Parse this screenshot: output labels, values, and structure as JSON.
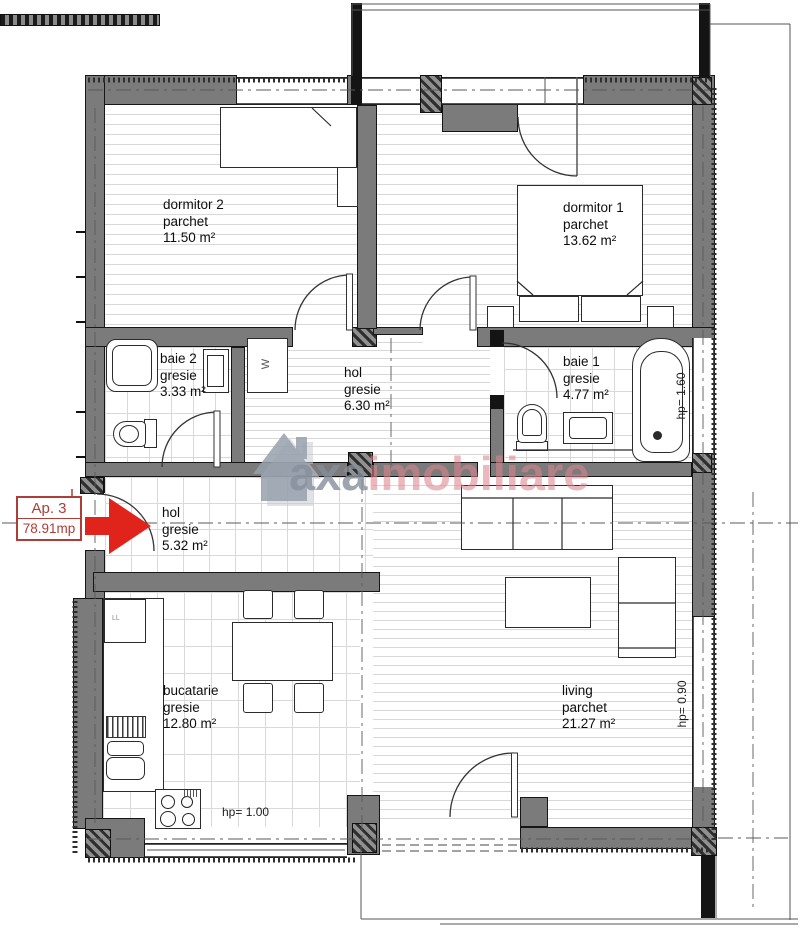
{
  "apartment": {
    "label": "Ap. 3",
    "total_area": "78.91mp"
  },
  "watermark": {
    "brand_primary": "axa",
    "brand_secondary": "imobiliare"
  },
  "rooms": [
    {
      "id": "dormitor-2",
      "name": "dormitor 2",
      "finish": "parchet",
      "area": "11.50 m²"
    },
    {
      "id": "dormitor-1",
      "name": "dormitor 1",
      "finish": "parchet",
      "area": "13.62 m²"
    },
    {
      "id": "baie-2",
      "name": "baie 2",
      "finish": "gresie",
      "area": "3.33 m²"
    },
    {
      "id": "hol-superior",
      "name": "hol",
      "finish": "gresie",
      "area": "6.30 m²"
    },
    {
      "id": "baie-1",
      "name": "baie 1",
      "finish": "gresie",
      "area": "4.77 m²"
    },
    {
      "id": "hol-inferior",
      "name": "hol",
      "finish": "gresie",
      "area": "5.32 m²"
    },
    {
      "id": "bucatarie",
      "name": "bucatarie",
      "finish": "gresie",
      "area": "12.80 m²"
    },
    {
      "id": "living",
      "name": "living",
      "finish": "parchet",
      "area": "21.27 m²"
    }
  ],
  "annotations": {
    "parapet_kitchen": "hp= 1.00",
    "parapet_living": "hp= 0.90",
    "parapet_bath": "hp= 1.60",
    "washer_label": "W",
    "fridge_label": "LL"
  },
  "colors": {
    "wall_gray": "#7b7b7b",
    "marker_red": "#e0241b",
    "label_red": "#ad3d36",
    "watermark_gray": "#99a1ab",
    "watermark_pink": "#d98f97"
  }
}
